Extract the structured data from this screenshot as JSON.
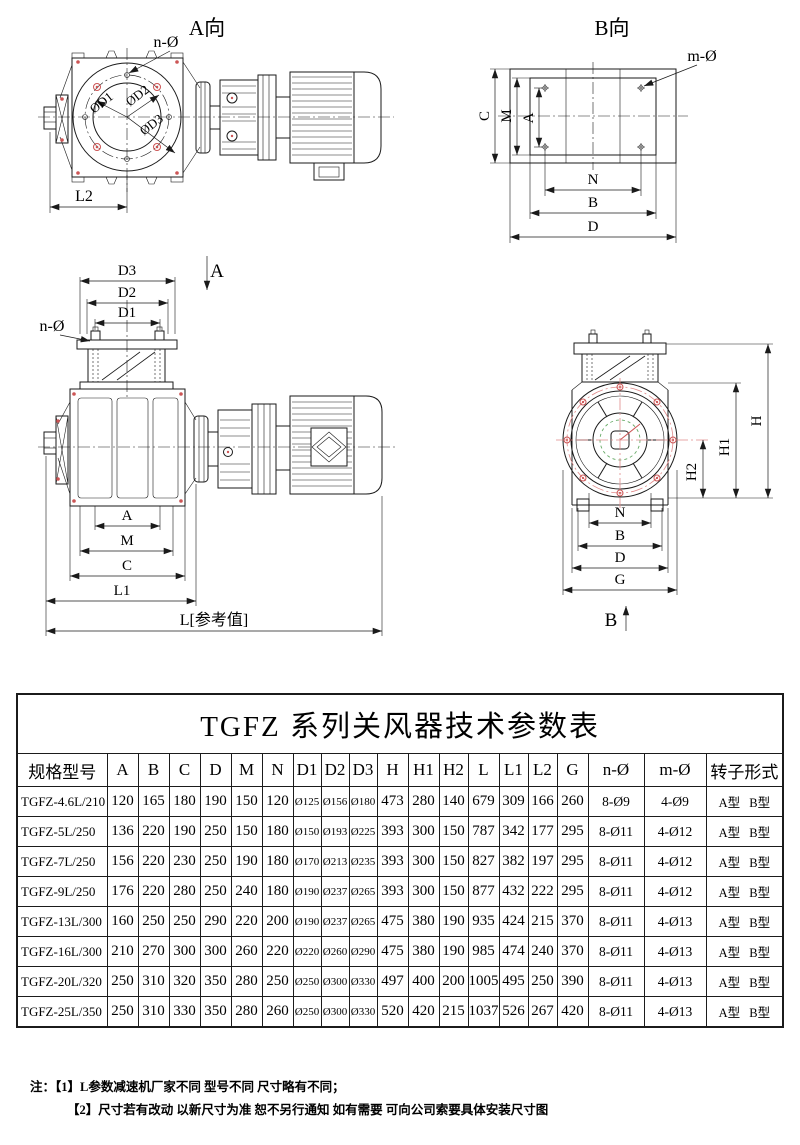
{
  "drawings": {
    "a_view": {
      "title": "A向",
      "hole_label": "n-Ø",
      "dia1": "ØD1",
      "dia2": "ØD2",
      "dia3": "ØD3",
      "dim_l2": "L2"
    },
    "b_view": {
      "title": "B向",
      "hole_label": "m-Ø",
      "dim_c": "C",
      "dim_m": "M",
      "dim_a": "A",
      "dim_n": "N",
      "dim_b": "B",
      "dim_d": "D"
    },
    "front_view": {
      "dim_d3": "D3",
      "dim_d2": "D2",
      "dim_d1": "D1",
      "hole_label": "n-Ø",
      "section_label": "A",
      "dim_a": "A",
      "dim_m": "M",
      "dim_c": "C",
      "dim_l1": "L1",
      "dim_l": "L[参考值]"
    },
    "side_view": {
      "dim_h": "H",
      "dim_h1": "H1",
      "dim_h2": "H2",
      "dim_n": "N",
      "dim_b": "B",
      "dim_d": "D",
      "dim_g": "G",
      "section_label": "B"
    }
  },
  "table": {
    "title": "TGFZ 系列关风器技术参数表",
    "headers": [
      "规格型号",
      "A",
      "B",
      "C",
      "D",
      "M",
      "N",
      "D1",
      "D2",
      "D3",
      "H",
      "H1",
      "H2",
      "L",
      "L1",
      "L2",
      "G",
      "n-Ø",
      "m-Ø",
      "转子形式"
    ],
    "rows": [
      [
        "TGFZ-4.6L/210",
        "120",
        "165",
        "180",
        "190",
        "150",
        "120",
        "Ø125",
        "Ø156",
        "Ø180",
        "473",
        "280",
        "140",
        "679",
        "309",
        "166",
        "260",
        "8-Ø9",
        "4-Ø9",
        "A型 B型"
      ],
      [
        "TGFZ-5L/250",
        "136",
        "220",
        "190",
        "250",
        "150",
        "180",
        "Ø150",
        "Ø193",
        "Ø225",
        "393",
        "300",
        "150",
        "787",
        "342",
        "177",
        "295",
        "8-Ø11",
        "4-Ø12",
        "A型 B型"
      ],
      [
        "TGFZ-7L/250",
        "156",
        "220",
        "230",
        "250",
        "190",
        "180",
        "Ø170",
        "Ø213",
        "Ø235",
        "393",
        "300",
        "150",
        "827",
        "382",
        "197",
        "295",
        "8-Ø11",
        "4-Ø12",
        "A型 B型"
      ],
      [
        "TGFZ-9L/250",
        "176",
        "220",
        "280",
        "250",
        "240",
        "180",
        "Ø190",
        "Ø237",
        "Ø265",
        "393",
        "300",
        "150",
        "877",
        "432",
        "222",
        "295",
        "8-Ø11",
        "4-Ø12",
        "A型 B型"
      ],
      [
        "TGFZ-13L/300",
        "160",
        "250",
        "250",
        "290",
        "220",
        "200",
        "Ø190",
        "Ø237",
        "Ø265",
        "475",
        "380",
        "190",
        "935",
        "424",
        "215",
        "370",
        "8-Ø11",
        "4-Ø13",
        "A型 B型"
      ],
      [
        "TGFZ-16L/300",
        "210",
        "270",
        "300",
        "300",
        "260",
        "220",
        "Ø220",
        "Ø260",
        "Ø290",
        "475",
        "380",
        "190",
        "985",
        "474",
        "240",
        "370",
        "8-Ø11",
        "4-Ø13",
        "A型 B型"
      ],
      [
        "TGFZ-20L/320",
        "250",
        "310",
        "320",
        "350",
        "280",
        "250",
        "Ø250",
        "Ø300",
        "Ø330",
        "497",
        "400",
        "200",
        "1005",
        "495",
        "250",
        "390",
        "8-Ø11",
        "4-Ø13",
        "A型 B型"
      ],
      [
        "TGFZ-25L/350",
        "250",
        "310",
        "330",
        "350",
        "280",
        "260",
        "Ø250",
        "Ø300",
        "Ø330",
        "520",
        "420",
        "215",
        "1037",
        "526",
        "267",
        "420",
        "8-Ø11",
        "4-Ø13",
        "A型 B型"
      ]
    ]
  },
  "notes": {
    "prefix": "注：",
    "items": [
      "【1】L参数减速机厂家不同 型号不同 尺寸略有不同；",
      "【2】尺寸若有改动 以新尺寸为准 恕不另行通知 如有需要 可向公司索要具体安装尺寸图"
    ]
  },
  "colors": {
    "line": "#1a1a1a",
    "accent_red": "#cc5555",
    "centerline_red": "#e08a8a",
    "accent_green": "#66aa66",
    "table_border": "#1b1b1b"
  }
}
